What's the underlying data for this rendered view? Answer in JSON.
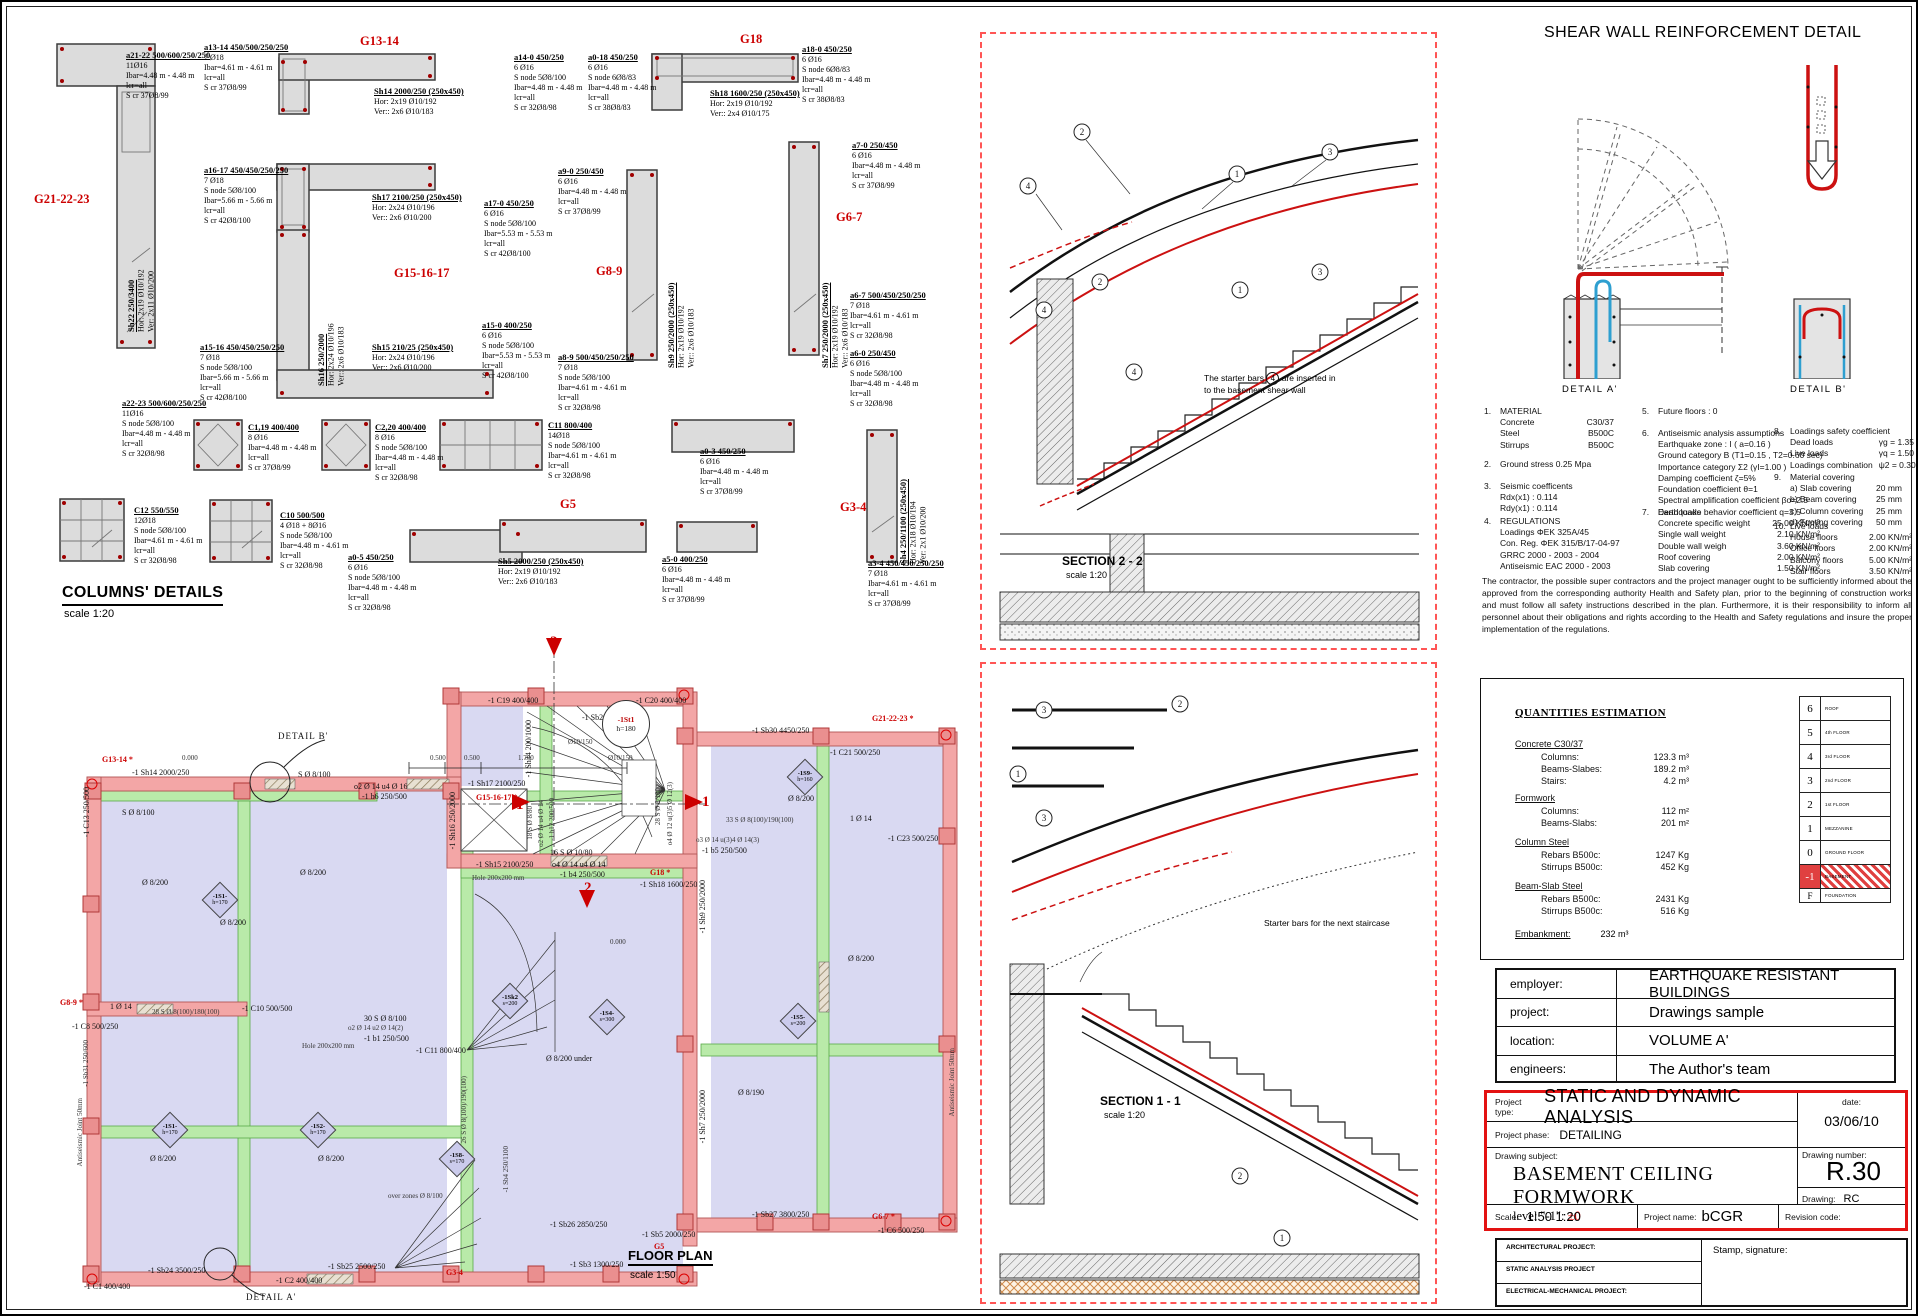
{
  "colors": {
    "accent_red": "#e31212",
    "grid_label_red": "#cc0000",
    "wall_pink": "#f3a6a6",
    "slab_lavender": "#d9d9f2",
    "beam_green": "#b9eaa9",
    "rebar_red": "#cc1111",
    "rebar_blue": "#2e9fd0"
  },
  "headers": {
    "columns_title": "COLUMNS' DETAILS",
    "columns_scale": "scale 1:20",
    "plan_title": "FLOOR PLAN",
    "plan_scale": "scale 1:50"
  },
  "columns": {
    "groups": {
      "g21": "G21-22-23",
      "g13": "G13-14",
      "g18": "G18",
      "g15": "G15-16-17",
      "g8": "G8-9",
      "g6": "G6-7",
      "g5": "G5",
      "g3": "G3-4"
    },
    "items": {
      "a2122": {
        "t": "a21-22 500/600/250/250",
        "b": "11Ø16\nIbar=4.48 m - 4.48 m\nlcr=all\nS cr 37Ø8/99"
      },
      "a1314": {
        "t": "a13-14 450/500/250/250",
        "b": "7 Ø18\nIbar=4.61 m - 4.61 m\nlcr=all\nS cr 37Ø8/99"
      },
      "sh14": {
        "t": "Sh14 2000/250 (250x450)",
        "b": "Hor: 2x19 Ø10/192\nVer:: 2x6 Ø10/183"
      },
      "a140": {
        "t": "a14-0 450/250",
        "b": "6 Ø16\nS node 5Ø8/100\nIbar=4.48 m - 4.48 m\nlcr=all\nS cr 32Ø8/98"
      },
      "a018": {
        "t": "a0-18 450/250",
        "b": "6 Ø16\nS node 6Ø8/83\nIbar=4.48 m - 4.48 m\nlcr=all\nS cr 38Ø8/83"
      },
      "a180": {
        "t": "a18-0 450/250",
        "b": "6 Ø16\nS node 6Ø8/83\nIbar=4.48 m - 4.48 m\nlcr=all\nS cr 38Ø8/83"
      },
      "sh18": {
        "t": "Sh18 1600/250 (250x450)",
        "b": "Hor: 2x19 Ø10/192\nVer:: 2x4 Ø10/175"
      },
      "a1617": {
        "t": "a16-17 450/450/250/250",
        "b": "7 Ø18\nS node 5Ø8/100\nIbar=5.66 m - 5.66 m\nlcr=all\nS cr 42Ø8/100"
      },
      "sh17": {
        "t": "Sh17 2100/250 (250x450)",
        "b": "Hor: 2x24 Ø10/196\nVer:: 2x6 Ø10/200"
      },
      "a170": {
        "t": "a17-0 450/250",
        "b": "6 Ø16\nS node 5Ø8/100\nIbar=5.53 m - 5.53 m\nlcr=all\nS cr 42Ø8/100"
      },
      "a90": {
        "t": "a9-0 250/450",
        "b": "6 Ø16\nIbar=4.48 m - 4.48 m\nlcr=all\nS cr 37Ø8/99"
      },
      "a70": {
        "t": "a7-0 250/450",
        "b": "6 Ø16\nIbar=4.48 m - 4.48 m\nlcr=all\nS cr 37Ø8/99"
      },
      "sh16": {
        "t": "Sh16 250/2000",
        "b": "Hor: 2x24 Ø10/196\nVer:: 2x6 Ø10/183"
      },
      "sh9": {
        "t": "Sh9 250/2000 (250x450)",
        "b": "Hor: 2x19 Ø10/192\nVer:: 2x6 Ø10/183"
      },
      "sh7": {
        "t": "Sh7 250/2000 (250x450)",
        "b": "Hor: 2x19 Ø10/192\nVer:: 2x6 Ø10/183"
      },
      "sh22": {
        "t": "Sh22 250/3400",
        "b": "Hor: 2x19 Ø10/192\nVer: 2x11 Ø10/200"
      },
      "a1516": {
        "t": "a15-16 450/450/250/250",
        "b": "7 Ø18\nS node 5Ø8/100\nIbar=5.66 m - 5.66 m\nlcr=all\nS cr 42Ø8/100"
      },
      "sh15": {
        "t": "Sh15 210/25 (250x450)",
        "b": "Hor: 2x24 Ø10/196\nVer:: 2x6 Ø10/200"
      },
      "a150": {
        "t": "a15-0 400/250",
        "b": "6 Ø16\nS node 5Ø8/100\nIbar=5.53 m - 5.53 m\nlcr=all\nS cr 42Ø8/100"
      },
      "a89": {
        "t": "a8-9 500/450/250/250",
        "b": "7 Ø18\nS node 5Ø8/100\nIbar=4.61 m - 4.61 m\nlcr=all\nS cr 32Ø8/98"
      },
      "a67": {
        "t": "a6-7 500/450/250/250",
        "b": "7 Ø18\nIbar=4.61 m - 4.61 m\nlcr=all\nS cr 32Ø8/98"
      },
      "a60": {
        "t": "a6-0 250/450",
        "b": "6 Ø16\nS node 5Ø8/100\nIbar=4.48 m - 4.48 m\nlcr=all\nS cr 32Ø8/98"
      },
      "a2223": {
        "t": "a22-23 500/600/250/250",
        "b": "11Ø16\nS node 5Ø8/100\nIbar=4.48 m - 4.48 m\nlcr=all\nS cr 32Ø8/98"
      },
      "c119": {
        "t": "C1,19 400/400",
        "b": "8 Ø16\nIbar=4.48 m - 4.48 m\nlcr=all\nS cr 37Ø8/99"
      },
      "c220": {
        "t": "C2,20 400/400",
        "b": "8 Ø16\nS node 5Ø8/100\nIbar=4.48 m - 4.48 m\nlcr=all\nS cr 32Ø8/98"
      },
      "c11": {
        "t": "C11 800/400",
        "b": "14Ø18\nS node 5Ø8/100\nIbar=4.61 m - 4.61 m\nlcr=all\nS cr 32Ø8/98"
      },
      "a03": {
        "t": "a0-3 450/250",
        "b": "6 Ø16\nIbar=4.48 m - 4.48 m\nlcr=all\nS cr 37Ø8/99"
      },
      "a34": {
        "t": "a3-4 450/450/250/250",
        "b": "7 Ø18\nIbar=4.61 m - 4.61 m\nlcr=all\nS cr 37Ø8/99"
      },
      "sh4": {
        "t": "Sh4 250/1100 (250x450)",
        "b": "Hor: 2x18 Ø10/194\nVer: 2x1 Ø10/200"
      },
      "c12": {
        "t": "C12 550/550",
        "b": "12Ø18\nS node 5Ø8/100\nIbar=4.61 m - 4.61 m\nlcr=all\nS cr 32Ø8/98"
      },
      "c10": {
        "t": "C10 500/500",
        "b": "4 Ø18 + 8Ø16\nS node 5Ø8/100\nIbar=4.48 m - 4.61 m\nlcr=all\nS cr 32Ø8/98"
      },
      "a05": {
        "t": "a0-5 450/250",
        "b": "6 Ø16\nS node 5Ø8/100\nIbar=4.48 m - 4.48 m\nlcr=all\nS cr 32Ø8/98"
      },
      "sh5": {
        "t": "Sh5 2000/250 (250x450)",
        "b": "Hor: 2x19 Ø10/192\nVer:: 2x6 Ø10/183"
      },
      "a50": {
        "t": "a5-0 400/250",
        "b": "6 Ø16\nIbar=4.48 m - 4.48 m\nlcr=all\nS cr 37Ø8/99"
      }
    }
  },
  "plan": {
    "labels": {
      "g13": "G13-14 *",
      "sh14": "-1 Sh14 2000/250",
      "c13": "-1 C13 250/500",
      "s8a": "S Ø 8/100",
      "s8b": "S Ø 8/100",
      "o2u416": "o2 Ø 14  u4 Ø 16",
      "b6": "-1 b6 250/500",
      "detb": "DETAIL  B'",
      "d5a": "0.500",
      "d5b": "0.500",
      "d17": "1.700",
      "c19": "-1 C19 400/400",
      "sb29": "-1 Sb29 2300/250",
      "c20": "-1 C20 400/400",
      "g21": "G21-22-23 *",
      "c21": "-1 C21 500/250",
      "sb30": "-1 Sb30 4450/250",
      "f15a": "Ø10/150",
      "f15b": "Ø10/150",
      "sh34": "-1 Sh34 200/1000",
      "sh17": "-1 Sh17 2100/250",
      "g15": "G15-16-17 *",
      "sh16": "-1 Sh16 250/2000",
      "s880": "18 S Ø 8/80",
      "o2u414": "o2 Ø 14 u4 Ø 14",
      "b12": "-1 b12 200/500",
      "s1080": "16 S Ø 10/80",
      "sh15": "-1 Sh15 2100/250",
      "o4u414": "o4 Ø 14 u4 Ø 14",
      "b4": "-1 b4 250/500",
      "g18": "G18 *",
      "sh18": "-1 Sh18 1600/250",
      "hole1": "Hole 200x200 mm",
      "s28100": "28 S Ø 8/100",
      "o4o12": "o4 Ø 12 u(3)5 Ø 12(3)",
      "f2a": "Ø 8/200",
      "f2b": "Ø 8/200",
      "f2c": "Ø 8/200",
      "f2d": "Ø 8/200",
      "f2e": "Ø 8/200",
      "f2f": "Ø 8/200",
      "f2g": "Ø 8/200",
      "s33": "33 S Ø 8(100)/190(100)",
      "i14a": "1 Ø 14",
      "c23": "-1 C23 500/250",
      "o3u34": "o3 Ø 14 u(3)4 Ø 14(3)",
      "b5": "-1 b5 250/500",
      "aj1": "Antiseismic Joint 50mm",
      "aj2": "Antiseismic Joint 50mm",
      "g8": "G8-9 *",
      "c8": "-1 C8 500/250",
      "i14b": "1 Ø 14",
      "s28": "28 S Ø 8(100)/180(100)",
      "c10": "-1 C10 500/500",
      "s30": "30 S Ø 8/100",
      "o2u214": "o2 Ø 14 u2 Ø 14(2)",
      "b1": "-1 b1 250/500",
      "c11": "-1 C11 800/400",
      "f190": "Ø 8/190",
      "sh9": "-1 Sh9 250/2000",
      "sh7": "-1 Sh7 250/2000",
      "s26": "26 S Ø 8(100)/190(100)",
      "sb4": "-1 Sb4 250/1100",
      "sb31": "-1 Sb31 250/600",
      "f2u": "Ø 8/200 under",
      "oz": "over zones Ø 8/100",
      "hole2": "Hole 200x200 mm",
      "sb26": "-1 Sb26 2850/250",
      "sb5": "-1 Sb5 2000/250",
      "sb27": "-1 Sb27 3800/250",
      "g6": "G6-7 *",
      "c6": "-1 C6 500/250",
      "sb25": "-1 Sb25 2500/250",
      "sb24": "-1 Sb24 3500/250",
      "c1": "-1 C1 400/400",
      "c2": "-1 C2 400/400",
      "sb3": "-1 Sb3 1300/250",
      "g3": "G3-4",
      "g5": "G5",
      "deta": "DETAIL  A'",
      "m1a": "1",
      "m1b": "1",
      "m2a": "2",
      "m2b": "2",
      "e0a": "0.000",
      "e0b": "0.000"
    },
    "st1": {
      "l1": "-1St1",
      "l2": "h=180"
    },
    "diamonds": [
      {
        "n": "-1S1-",
        "v": "h=170"
      },
      {
        "n": "-1S2-",
        "v": "h=170"
      },
      {
        "n": "-1S1-",
        "v": "h=170"
      },
      {
        "n": "-1S4-",
        "v": "s=300"
      },
      {
        "n": "-1S5-",
        "v": "s=200"
      },
      {
        "n": "-1S9-",
        "v": "h=160"
      },
      {
        "n": "-1S8-",
        "v": "s=170"
      },
      {
        "n": "-1Sk2",
        "v": "s=200"
      }
    ]
  },
  "sections": {
    "s22": {
      "title": "SECTION  2 - 2",
      "scale": "scale  1:20",
      "note_pre": "The starter bars",
      "note_num": "4",
      "note_post": "are inserted in\nto the basement shear wall"
    },
    "s11": {
      "title": "SECTION  1 - 1",
      "scale": "scale  1:20",
      "note": "Starter bars for the next staircase"
    },
    "markers": {
      "m1": "1",
      "m2": "2",
      "m3": "3",
      "m4": "4"
    }
  },
  "shear": {
    "title": "SHEAR WALL REINFORCEMENT DETAIL",
    "a": "DETAIL  A'",
    "b": "DETAIL  B'"
  },
  "notes": {
    "n1": {
      "num": "1.",
      "title": "MATERIAL",
      "rows": [
        [
          "Concrete",
          "C30/37"
        ],
        [
          "Steel",
          "B500C"
        ],
        [
          "Stirrups",
          "B500C"
        ]
      ]
    },
    "n2": {
      "num": "2.",
      "title": "Ground stress  0.25 Mpa"
    },
    "n3": {
      "num": "3.",
      "title": "Seismic coefficents",
      "body": "Rdx(x1) : 0.114\nRdy(x1) : 0.114"
    },
    "n4": {
      "num": "4.",
      "title": "REGULATIONS",
      "body": "Loadings ΦEK 325A/45\nCon. Reg. ΦEK 315/B/17-04-97\nGRRC 2000 - 2003 - 2004\nAntiseismic EAC 2000 - 2003"
    },
    "n5": {
      "num": "5.",
      "title": "Future floors : 0"
    },
    "n6": {
      "num": "6.",
      "title": "Antiseismic analysis assumptions",
      "body": "Earthquake zone : I  ( a=0.16 )\nGround category B (T1=0.15 , T2=0.60 sec)\nImportance category Σ2 (γI=1.00 )\nDamping coefficient ζ=5%\nFoundation coefficient  θ=1\nSpectral amplification coefficient βo=2.5\nEarthquake behavior coefficient q=3.5"
    },
    "n7": {
      "num": "7.",
      "title": "Dead loads",
      "rows": [
        [
          "Concrete specific weight",
          "25.00 KN/m³"
        ],
        [
          "Single wall weight",
          "2.10 KN/m²"
        ],
        [
          "Double wall weigh",
          "3.60 KN/m²"
        ],
        [
          "Roof covering",
          "2.00 KN/m²"
        ],
        [
          "Slab covering",
          "1.50 KN/m²"
        ]
      ]
    },
    "n8": {
      "num": "8.",
      "title": "Loadings safety coefficient",
      "rows": [
        [
          "Dead loads",
          "γg = 1.35"
        ],
        [
          "Live loads",
          "γq = 1.50"
        ],
        [
          "Loadings combination",
          "ψ2 = 0.30"
        ]
      ]
    },
    "n9": {
      "num": "9.",
      "title": "Material covering",
      "rows": [
        [
          "a) Slab covering",
          "20 mm"
        ],
        [
          "b) Beam covering",
          "25 mm"
        ],
        [
          "c) Column covering",
          "25 mm"
        ],
        [
          "d) Footing covering",
          "50 mm"
        ]
      ]
    },
    "n10": {
      "num": "10.",
      "title": "Live loads",
      "rows": [
        [
          "House floors",
          "2.00 KN/m²"
        ],
        [
          "Office floors",
          "2.00 KN/m²"
        ],
        [
          "Balcony floors",
          "5.00 KN/m²"
        ],
        [
          "Stair floors",
          "3.50 KN/m²"
        ]
      ]
    }
  },
  "disclaimer": "The contractor, the possible super contractors and the project manager ought to be sufficiently informed about the approved from the corresponding authority Health and Safety plan, prior to the beginning of construction works and must follow all safety instructions described in the plan. Furthermore, it is their responsibility to inform all personnel about their obligations and rights according to the Health and Safety regulations and insure the proper implementation of the regulations.",
  "quantities": {
    "title": "QUANTITIES ESTIMATION",
    "sections": [
      {
        "head": "Concrete C30/37",
        "rows": [
          [
            "Columns:",
            "123.3 m³"
          ],
          [
            "Beams-Slabes:",
            "189.2 m³"
          ],
          [
            "Stairs:",
            "4.2 m³"
          ]
        ]
      },
      {
        "head": "Formwork",
        "rows": [
          [
            "Columns:",
            "112 m²"
          ],
          [
            "Beams-Slabs:",
            "201 m²"
          ]
        ]
      },
      {
        "head": "Column Steel",
        "rows": [
          [
            "Rebars B500c:",
            "1247 Kg"
          ],
          [
            "Stirrups B500c:",
            "452 Kg"
          ]
        ]
      },
      {
        "head": "Beam-Slab Steel",
        "rows": [
          [
            "Rebars B500c:",
            "2431 Kg"
          ],
          [
            "Stirrups B500c:",
            "516 Kg"
          ]
        ]
      }
    ],
    "embankment_label": "Embankment:",
    "embankment_value": "232 m³",
    "floors": [
      [
        "6",
        "ROOF"
      ],
      [
        "5",
        "4th FLOOR"
      ],
      [
        "4",
        "3rd FLOOR"
      ],
      [
        "3",
        "2nd FLOOR"
      ],
      [
        "2",
        "1st FLOOR"
      ],
      [
        "1",
        "MEZZANINE"
      ],
      [
        "0",
        "GROUND FLOOR"
      ],
      [
        "-1",
        "BASEMENT"
      ],
      [
        "F",
        "FOUNDATION"
      ]
    ]
  },
  "info": {
    "rows": [
      [
        "employer:",
        "EARTHQUAKE RESISTANT BUILDINGS"
      ],
      [
        "project:",
        "Drawings sample"
      ],
      [
        "location:",
        "VOLUME A'"
      ],
      [
        "engineers:",
        "The Author's team"
      ]
    ]
  },
  "titleblock": {
    "project_type_label": "Project type:",
    "project_type": "STATIC AND DYNAMIC ANALYSIS",
    "date_label": "date:",
    "date": "03/06/10",
    "project_phase_label": "Project phase:",
    "project_phase": "DETAILING",
    "drawing_subject_label": "Drawing subject:",
    "drawing_subject": "BASEMENT CEILING FORMWORK",
    "level_prefix": "level \"-1\":",
    "level_value": "±0",
    "drawing_number_label": "Drawing number:",
    "drawing_number": "R.30",
    "drawing_label": "Drawing:",
    "drawing": "RC",
    "scale_label": "Scale:",
    "scale": "1:50   1:20",
    "project_name_label": "Project name:",
    "project_name": "bCGR",
    "revision_label": "Revision code:"
  },
  "bottom": {
    "rows": [
      "ARCHITECTURAL PROJECT:",
      "STATIC ANALYSIS PROJECT",
      "ELECTRICAL-MECHANICAL PROJECT:"
    ],
    "stamp": "Stamp, signature:"
  }
}
